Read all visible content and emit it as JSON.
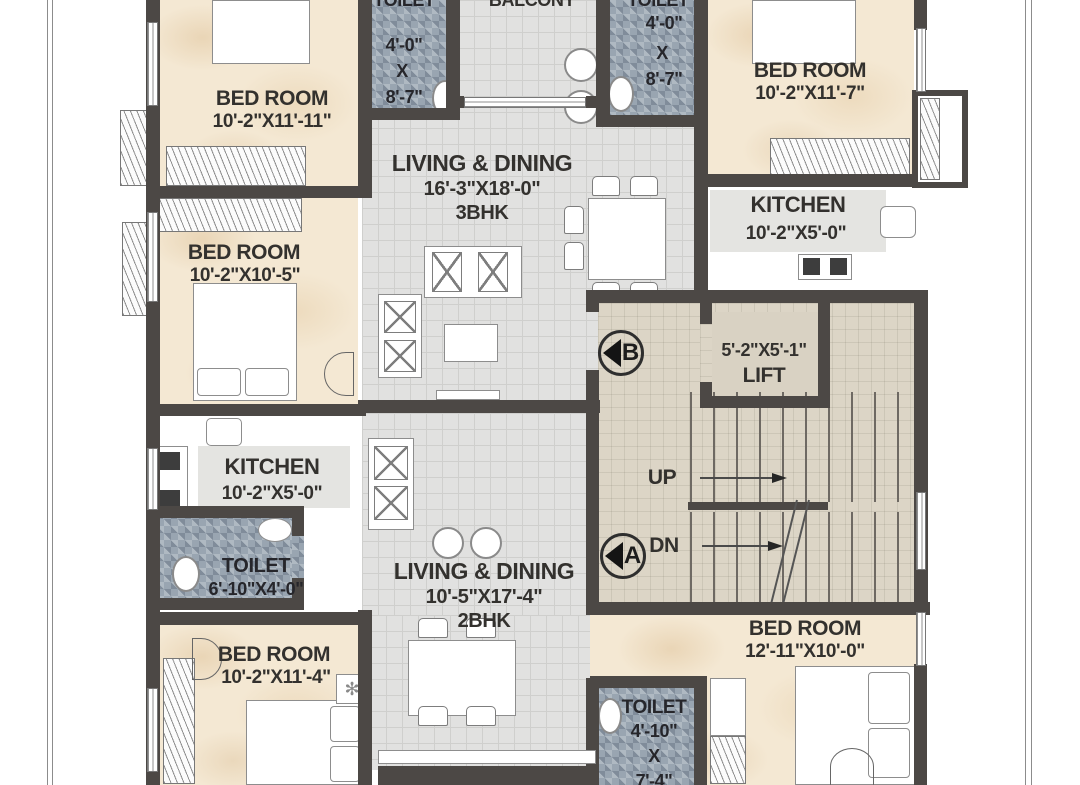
{
  "colors": {
    "wall": "#4c4845",
    "bedroom_floor": "#f4e8d3",
    "tile_floor": "#e1e1e0",
    "toilet_floor": "#99a5b1",
    "lobby_floor": "#dcd5c6",
    "lift_floor": "#d9d2c3",
    "label_text": "#33312e"
  },
  "rooms": {
    "bedroom_tl": {
      "name": "BED ROOM",
      "dims": "10'-2\"X11'-11\""
    },
    "toilet_tl": {
      "name": "TOILET",
      "lines": [
        "4'-0\"",
        "X",
        "8'-7\""
      ]
    },
    "balcony": {
      "name": "BALCONY"
    },
    "toilet_tr": {
      "name": "TOILET",
      "lines": [
        "4'-0\"",
        "X",
        "8'-7\""
      ]
    },
    "bedroom_tr": {
      "name": "BED ROOM",
      "dims": "10'-2\"X11'-7\""
    },
    "living_3bhk": {
      "name": "LIVING & DINING",
      "dims": "16'-3\"X18'-0\"",
      "unit": "3BHK"
    },
    "kitchen_right": {
      "name": "KITCHEN",
      "dims": "10'-2\"X5'-0\""
    },
    "bedroom_ml": {
      "name": "BED ROOM",
      "dims": "10'-2\"X10'-5\""
    },
    "lift": {
      "dims": "5'-2\"X5'-1\"",
      "name": "LIFT"
    },
    "stairs": {
      "up_label": "UP",
      "down_label": "DN"
    },
    "kitchen_left": {
      "name": "KITCHEN",
      "dims": "10'-2\"X5'-0\""
    },
    "toilet_left": {
      "name": "TOILET",
      "dims": "6'-10\"X4'-0\""
    },
    "living_2bhk": {
      "name": "LIVING & DINING",
      "dims": "10'-5\"X17'-4\"",
      "unit": "2BHK"
    },
    "bedroom_bl": {
      "name": "BED ROOM",
      "dims": "10'-2\"X11'-4\""
    },
    "bedroom_br": {
      "name": "BED ROOM",
      "dims": "12'-11\"X10'-0\""
    },
    "toilet_bottom": {
      "name": "TOILET",
      "lines": [
        "4'-10\"",
        "X",
        "7'-4\""
      ]
    }
  },
  "markers": {
    "flat_b": "B",
    "flat_a": "A"
  },
  "icons": {
    "geyser": "✻"
  }
}
